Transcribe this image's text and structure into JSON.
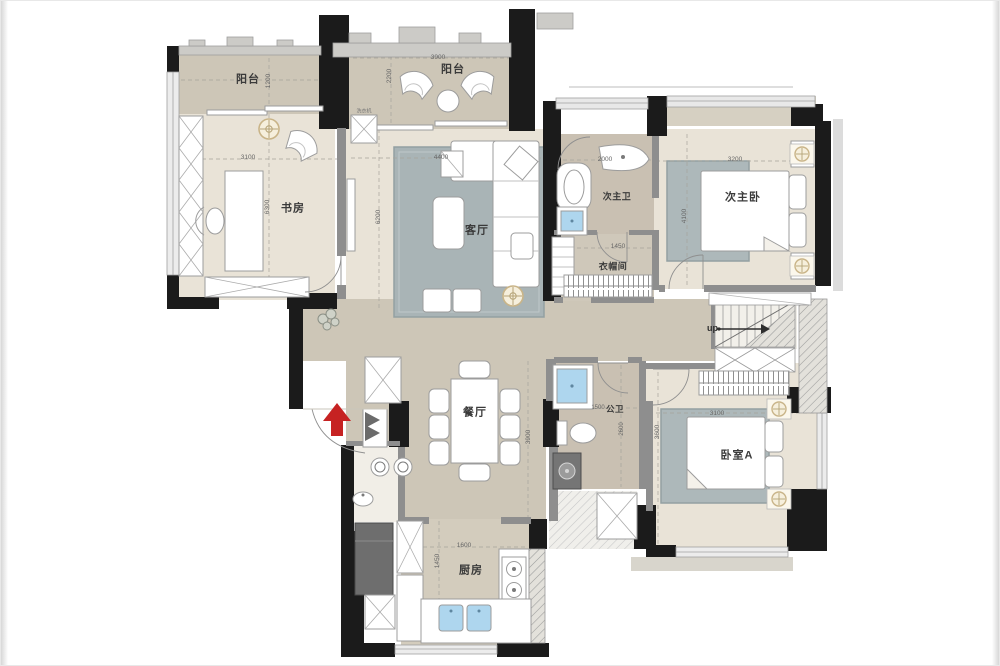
{
  "plan": {
    "title": "apartment-floor-plan",
    "colors": {
      "wall_black": "#1b1b1b",
      "partition_gray": "#8e8e8e",
      "floor_dark_beige": "#cdc6b7",
      "floor_light_beige": "#e9e3d7",
      "floor_bath": "#c9c0b2",
      "rug_blue_gray": "#a9b4b6",
      "entry_arrow_red": "#c62222",
      "sink_blue": "#aed6ee",
      "light_gold": "#c9b488"
    },
    "rooms": {
      "balcony_left": {
        "label": "阳台",
        "dim_depth": "1200"
      },
      "balcony_top": {
        "label": "阳台",
        "dim_width": "3900",
        "dim_depth": "2200"
      },
      "study": {
        "label": "书房",
        "dim_width": "3100",
        "dim_depth": "6300"
      },
      "living": {
        "label": "客厅",
        "dim_width": "4400",
        "dim_depth": "6200"
      },
      "bath_second": {
        "label": "次主卫",
        "dim_width": "2000"
      },
      "bedroom_second": {
        "label": "次主卧",
        "dim_width": "3200",
        "dim_depth": "4100"
      },
      "closet": {
        "label": "衣帽间",
        "dim_width": "1450"
      },
      "stairs": {
        "label": "up"
      },
      "dining": {
        "label": "餐厅",
        "dim_depth": "3900"
      },
      "bath_public": {
        "label": "公卫",
        "dim_width": "1500",
        "dim_depth": "2600"
      },
      "bedroom_a": {
        "label": "卧室A",
        "dim_width": "3100",
        "dim_depth": "3600"
      },
      "kitchen": {
        "label": "厨房",
        "dim_width": "1600",
        "dim_depth": "1450"
      },
      "appliance_note": {
        "label": "洗衣机"
      }
    }
  }
}
